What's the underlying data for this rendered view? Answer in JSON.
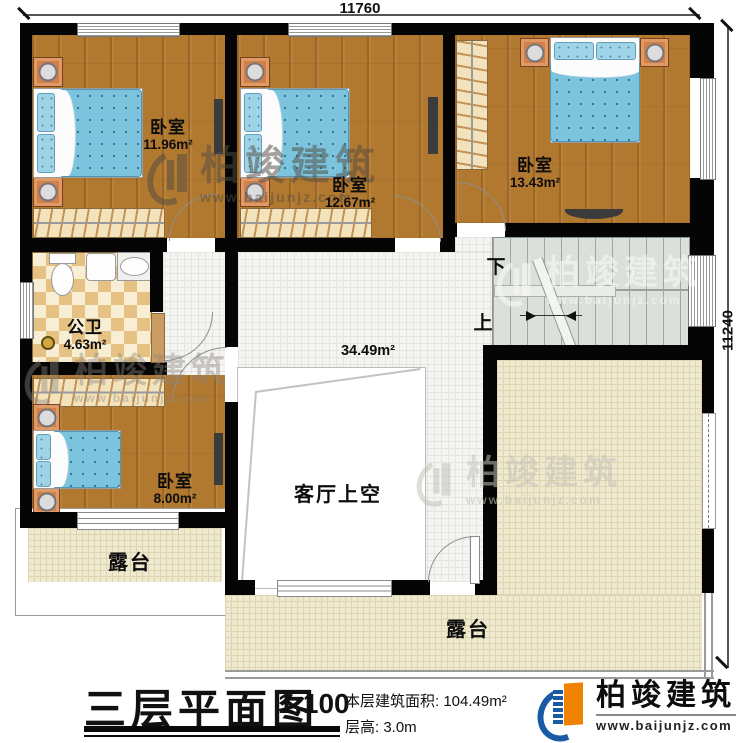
{
  "dimensions": {
    "top": "11760",
    "right": "11240"
  },
  "rooms": {
    "bedroom1": {
      "name": "卧室",
      "area": "11.96m²"
    },
    "bedroom2": {
      "name": "卧室",
      "area": "12.67m²"
    },
    "bedroom3": {
      "name": "卧室",
      "area": "13.43m²"
    },
    "bathroom": {
      "name": "公卫",
      "area": "4.63m²"
    },
    "bedroom4": {
      "name": "卧室",
      "area": "8.00m²"
    },
    "living_void": {
      "name": "客厅上空",
      "area": "34.49m²"
    },
    "terrace_left": {
      "name": "露台"
    },
    "terrace_right": {
      "name": "露台"
    }
  },
  "stairs": {
    "down": "下",
    "up": "上"
  },
  "watermark": {
    "brand": "柏竣建筑",
    "url": "www.baijunjz.com"
  },
  "title_block": {
    "title": "三层平面图",
    "scale": "1:100",
    "floor_area": "本层建筑面积: 104.49m²",
    "floor_height": "层高: 3.0m"
  },
  "logo": {
    "brand": "柏竣建筑",
    "url": "www.baijunjz.com"
  },
  "colors": {
    "wall": "#050505",
    "wood_floor": "#b1782f",
    "bed_blue": "#7cc4de",
    "logo_blue": "#1a5ba6",
    "logo_orange": "#ef8200"
  }
}
